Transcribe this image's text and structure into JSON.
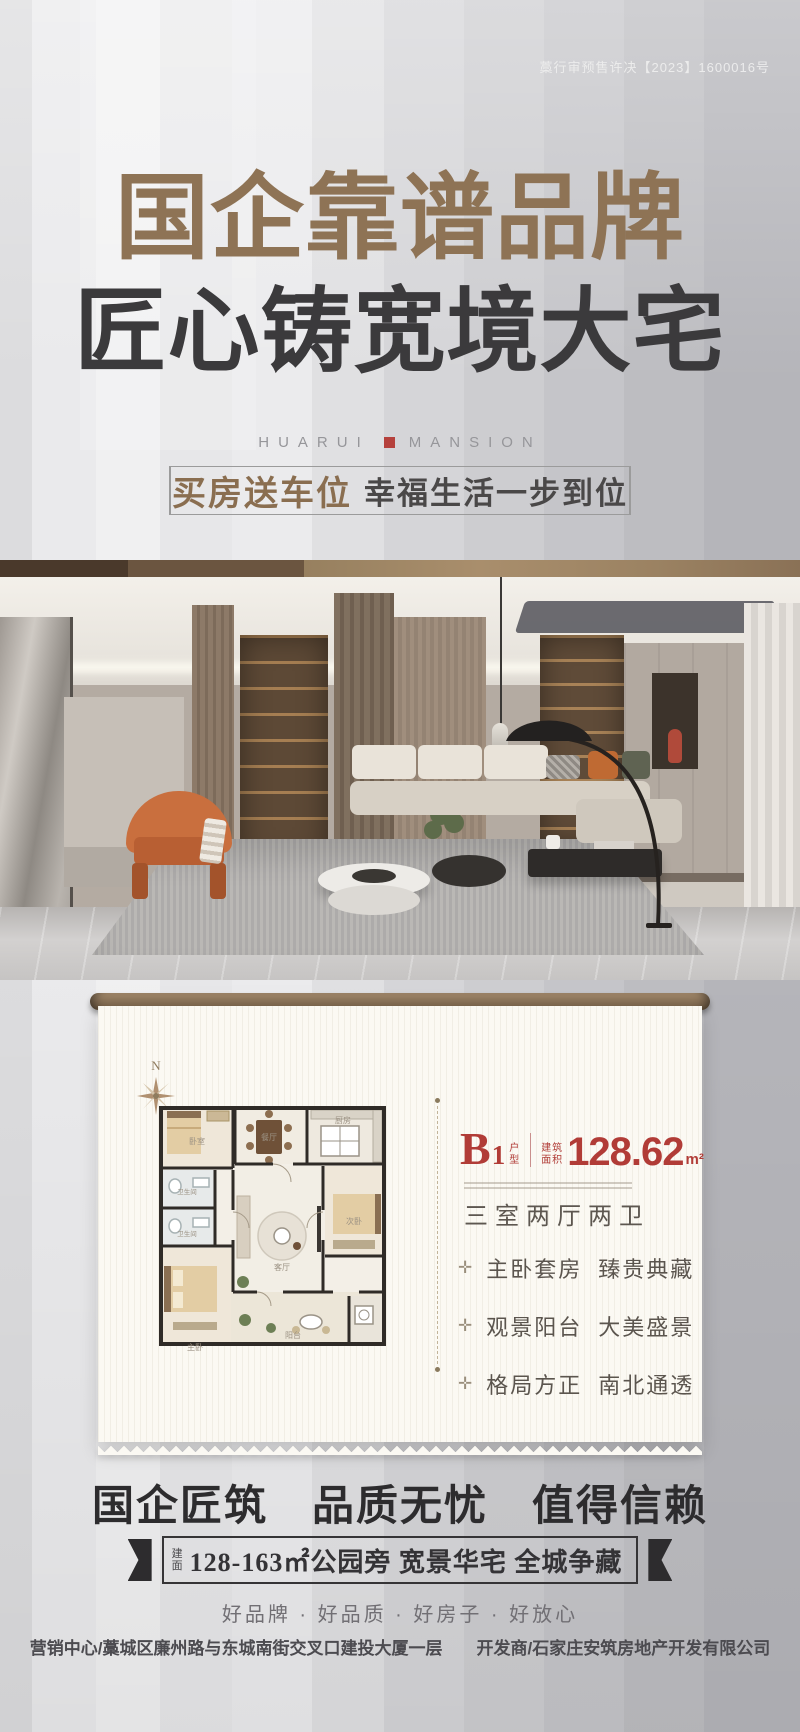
{
  "permit_number": "藁行审预售许决【2023】1600016号",
  "hero": {
    "title_line1": "国企靠谱品牌",
    "title_line2": "匠心铸宽境大宅",
    "brand_word_left": "HUARUI",
    "brand_word_right": "MANSION",
    "slogan_highlight": "买房送车位",
    "slogan_text": "幸福生活一步到位"
  },
  "floorplan_card": {
    "compass_north": "N",
    "unit": {
      "letter": "B",
      "number": "1",
      "label_top": "户",
      "label_bottom": "型"
    },
    "area": {
      "label_top": "建筑",
      "label_bottom": "面积",
      "value": "128.62",
      "unit": "m²"
    },
    "layout_text": "三室两厅两卫",
    "feature_bullet": "✛",
    "features": [
      {
        "head": "主卧套房",
        "tail": "臻贵典藏"
      },
      {
        "head": "观景阳台",
        "tail": "大美盛景"
      },
      {
        "head": "格局方正",
        "tail": "南北通透"
      }
    ],
    "rooms": {
      "bedroom_top": "卧室",
      "bath_upper": "卫生间",
      "bath_lower": "卫生间",
      "master_bedroom": "主卧",
      "dining": "餐厅",
      "kitchen": "厨房",
      "living": "客厅",
      "bedroom_right": "次卧",
      "balcony": "阳台"
    }
  },
  "bottom": {
    "headline": "国企匠筑　品质无忧　值得信赖",
    "banner": {
      "prefix_top": "建",
      "prefix_bottom": "面",
      "text": "128-163㎡公园旁 宽景华宅 全城争藏"
    },
    "tagline": "好品牌 · 好品质 · 好房子 · 好放心",
    "footer_left": "营销中心/藁城区廉州路与东城南街交叉口建投大厦一层",
    "footer_right": "开发商/石家庄安筑房地产开发有限公司"
  },
  "colors": {
    "accent_red": "#b13c37",
    "title_bronze": "#8e7355",
    "ink": "#2d2c2e",
    "rod_brown": "#8a7258"
  }
}
